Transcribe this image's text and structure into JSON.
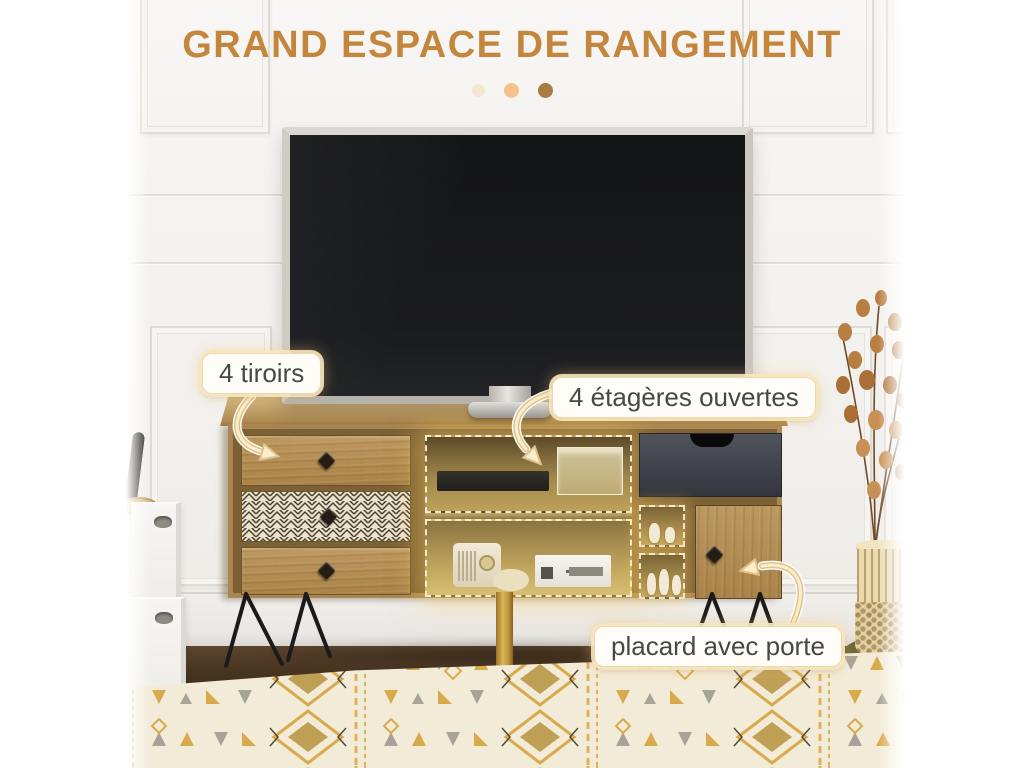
{
  "header": {
    "title": "GRAND ESPACE DE RANGEMENT",
    "carousel_dots": [
      "dot-1",
      "dot-2",
      "dot-3"
    ]
  },
  "callouts": [
    {
      "id": "drawers",
      "label": "4 tiroirs",
      "icon": "curved-arrow-icon",
      "points_to": "drawer-stack"
    },
    {
      "id": "shelves",
      "label": "4 étagères ouvertes",
      "icon": "curved-arrow-icon",
      "points_to": "open-shelves"
    },
    {
      "id": "cabinet",
      "label": "placard avec porte",
      "icon": "curved-arrow-icon",
      "points_to": "cabinet-door"
    }
  ],
  "scene": {
    "items": [
      "tv",
      "tv-stand",
      "three-front-drawers",
      "herringbone-drawer",
      "dark-top-drawer",
      "open-shelves-highlighted",
      "cabinet-door",
      "hairpin-legs",
      "gold-center-leg",
      "storage-boxes",
      "table-lamp",
      "dried-plant-basket",
      "patterned-bedspread",
      "paneled-wall",
      "wood-floor"
    ]
  },
  "colors": {
    "accent_title": "#c4863d",
    "label_text": "#474747",
    "label_bg": "#fffdf7",
    "label_border": "#ecd9b4",
    "arrow_gold": "#dfc08a",
    "arrow_cream": "#f9edca",
    "dot_1": "#f2e7cf",
    "dot_2": "#f6c28c",
    "dot_3": "#aa7c43",
    "wood_light": "#c7a977",
    "wood_mid": "#ad8a52",
    "highlight_glow": "#fccc60",
    "dark_drawer": "#3b3e45"
  }
}
